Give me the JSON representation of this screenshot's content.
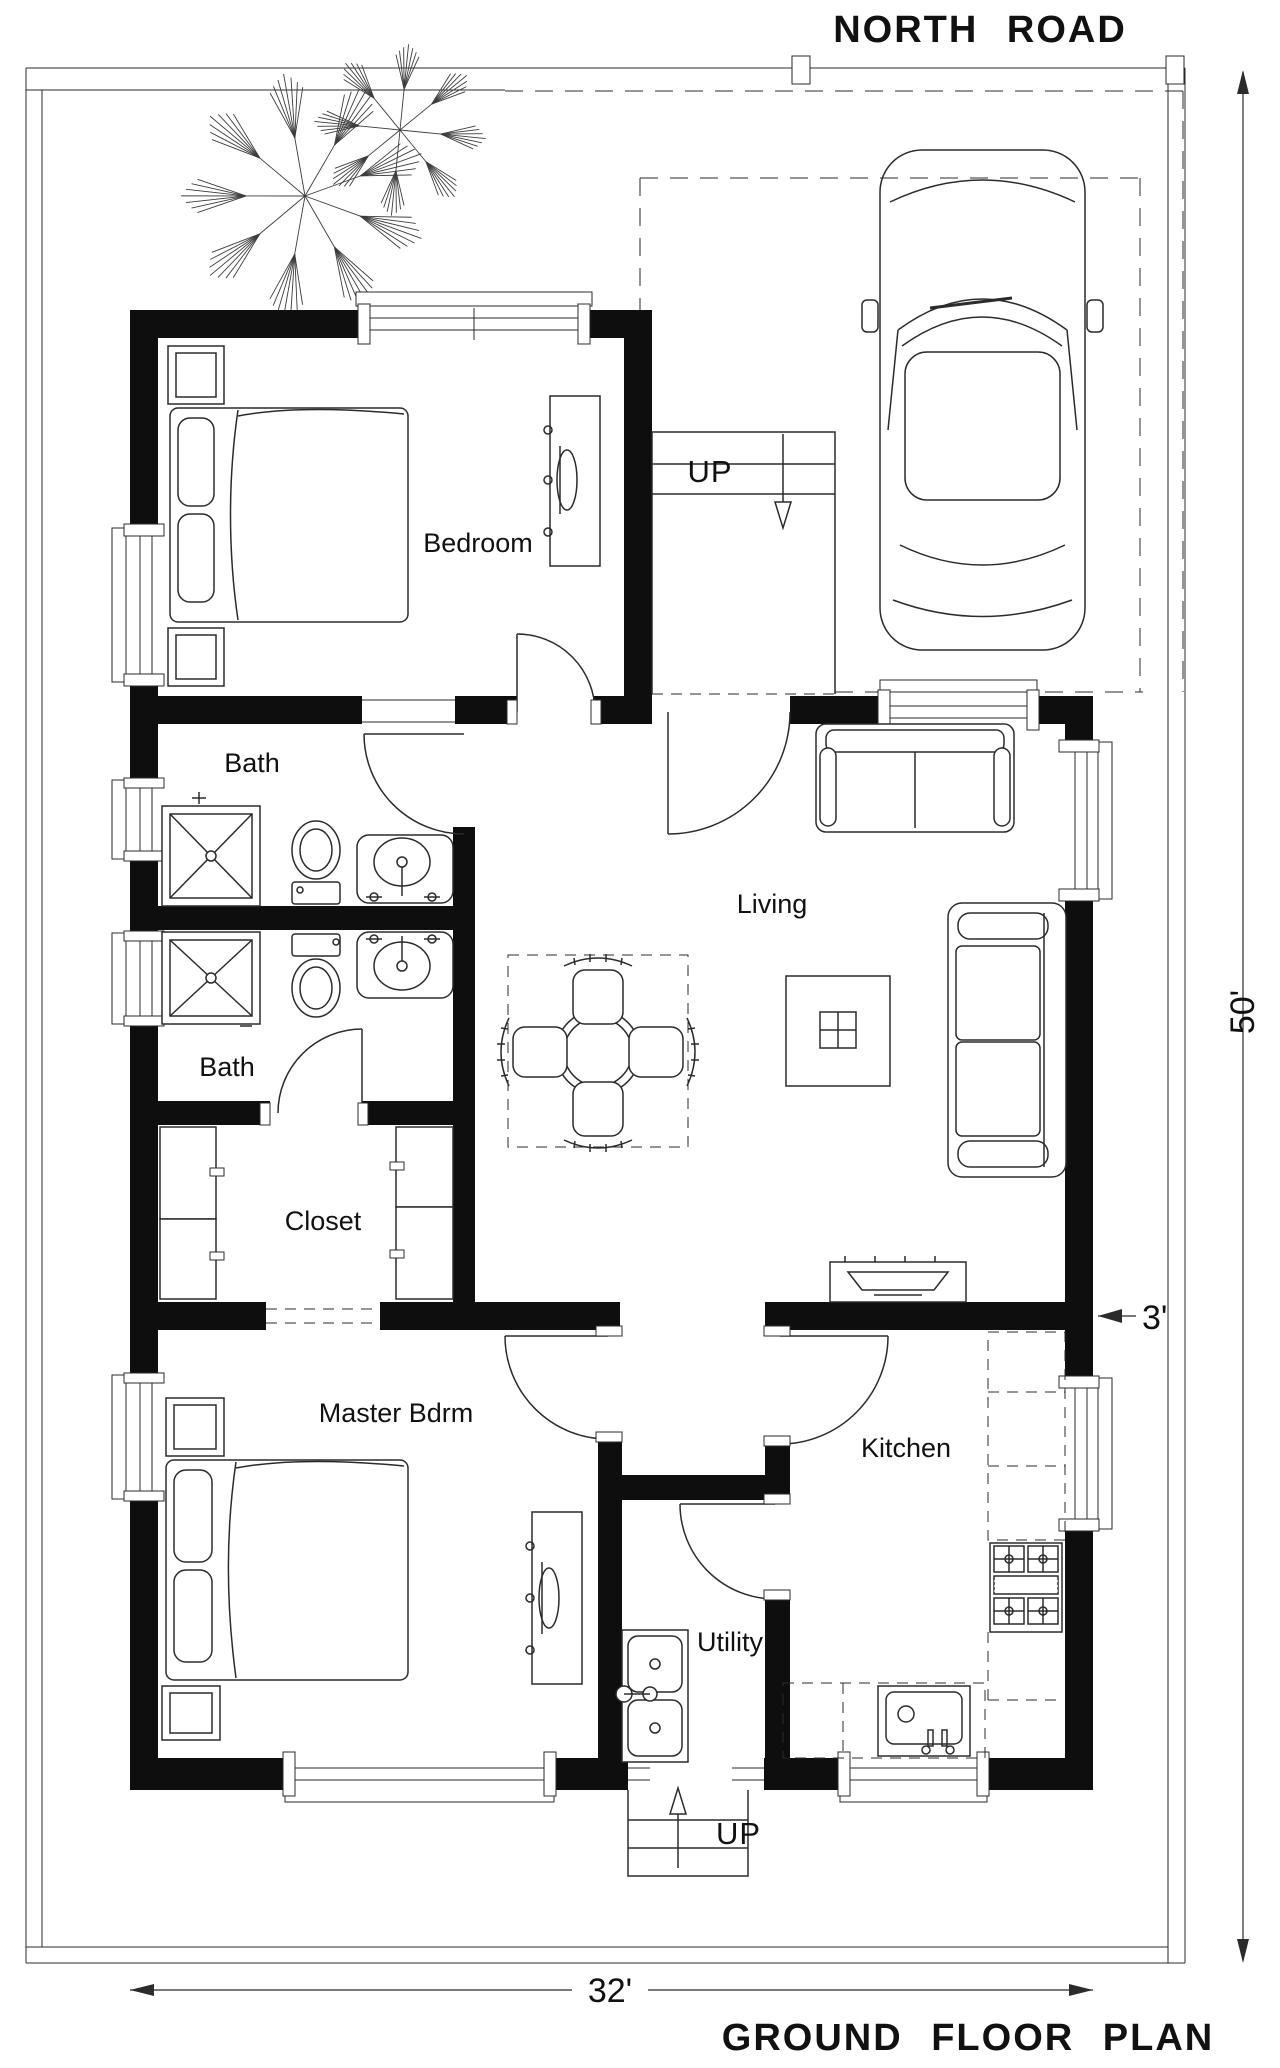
{
  "labels": {
    "road": "NORTH ROAD",
    "plan_title": "GROUND FLOOR PLAN"
  },
  "dimensions": {
    "lot_depth": "50'",
    "house_width": "32'",
    "side_setback": "3'"
  },
  "rooms": {
    "bedroom": "Bedroom",
    "bath1": "Bath",
    "bath2": "Bath",
    "closet": "Closet",
    "master": "Master Bdrm",
    "living": "Living",
    "kitchen": "Kitchen",
    "utility": "Utility"
  },
  "stairs": {
    "top": "UP",
    "bottom": "UP"
  },
  "icons": [
    "tree-icon",
    "car-icon",
    "bed",
    "master-bed",
    "nightstand",
    "dresser-tv",
    "shower",
    "toilet",
    "vanity-sink",
    "closet-shelves",
    "dining-table",
    "dining-chair",
    "coffee-table",
    "sofa",
    "loveseat",
    "tv-console",
    "stove",
    "kitchen-counter",
    "kitchen-sink",
    "utility-sink",
    "door-arc",
    "window",
    "stairs"
  ],
  "colors": {
    "background": "#ffffff",
    "walls": "#0e0e0e",
    "lines": "#2b2b2b",
    "text": "#111111"
  }
}
